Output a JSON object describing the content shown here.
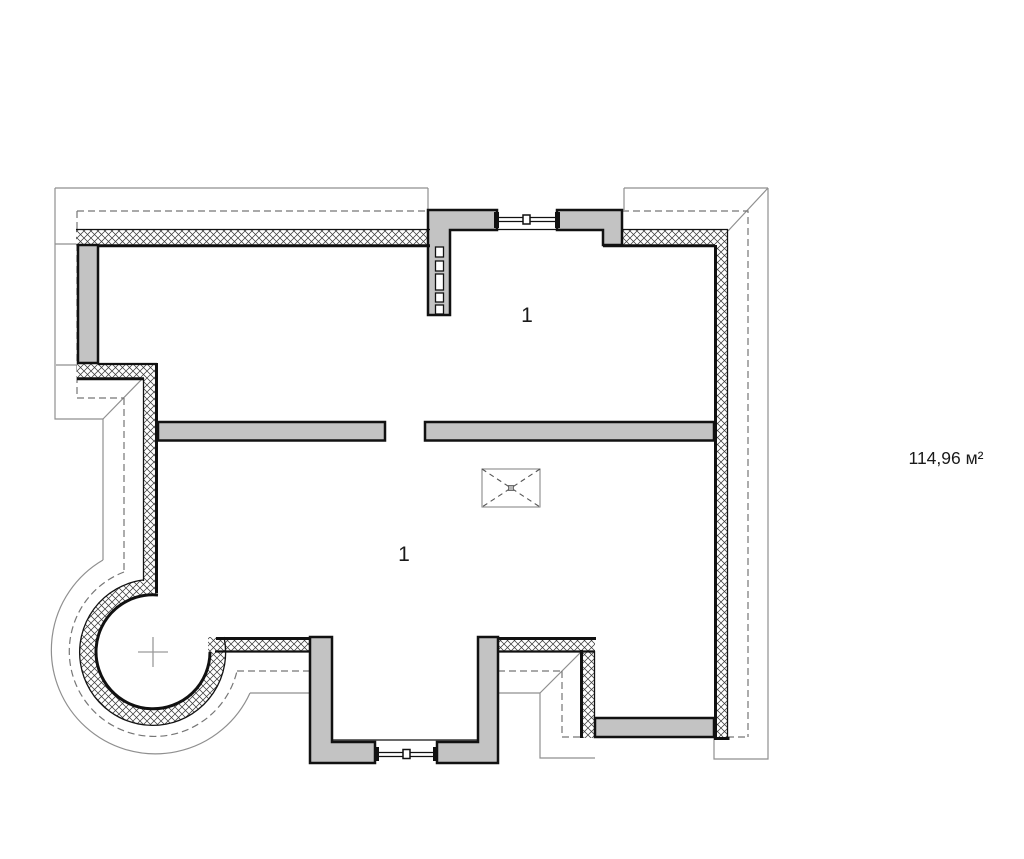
{
  "drawing": {
    "kind": "floor-plan",
    "labels": {
      "room_top": "1",
      "room_bottom": "1",
      "area": "114,96 м²"
    },
    "symbols": {
      "shaft": "crossed-box-opening",
      "bay_center": "plus-center-mark",
      "flue_block": "chimney-flue-block-5-holes",
      "window_top": "double-line-window",
      "window_bottom": "double-line-window"
    },
    "colors": {
      "wall_gray": "#c3c3c3",
      "outline_black": "#111111",
      "hatch_line": "#3a3a3a",
      "roof_line_gray": "#8f8f8f",
      "eave_dash_gray": "#767676",
      "background": "#ffffff"
    }
  }
}
